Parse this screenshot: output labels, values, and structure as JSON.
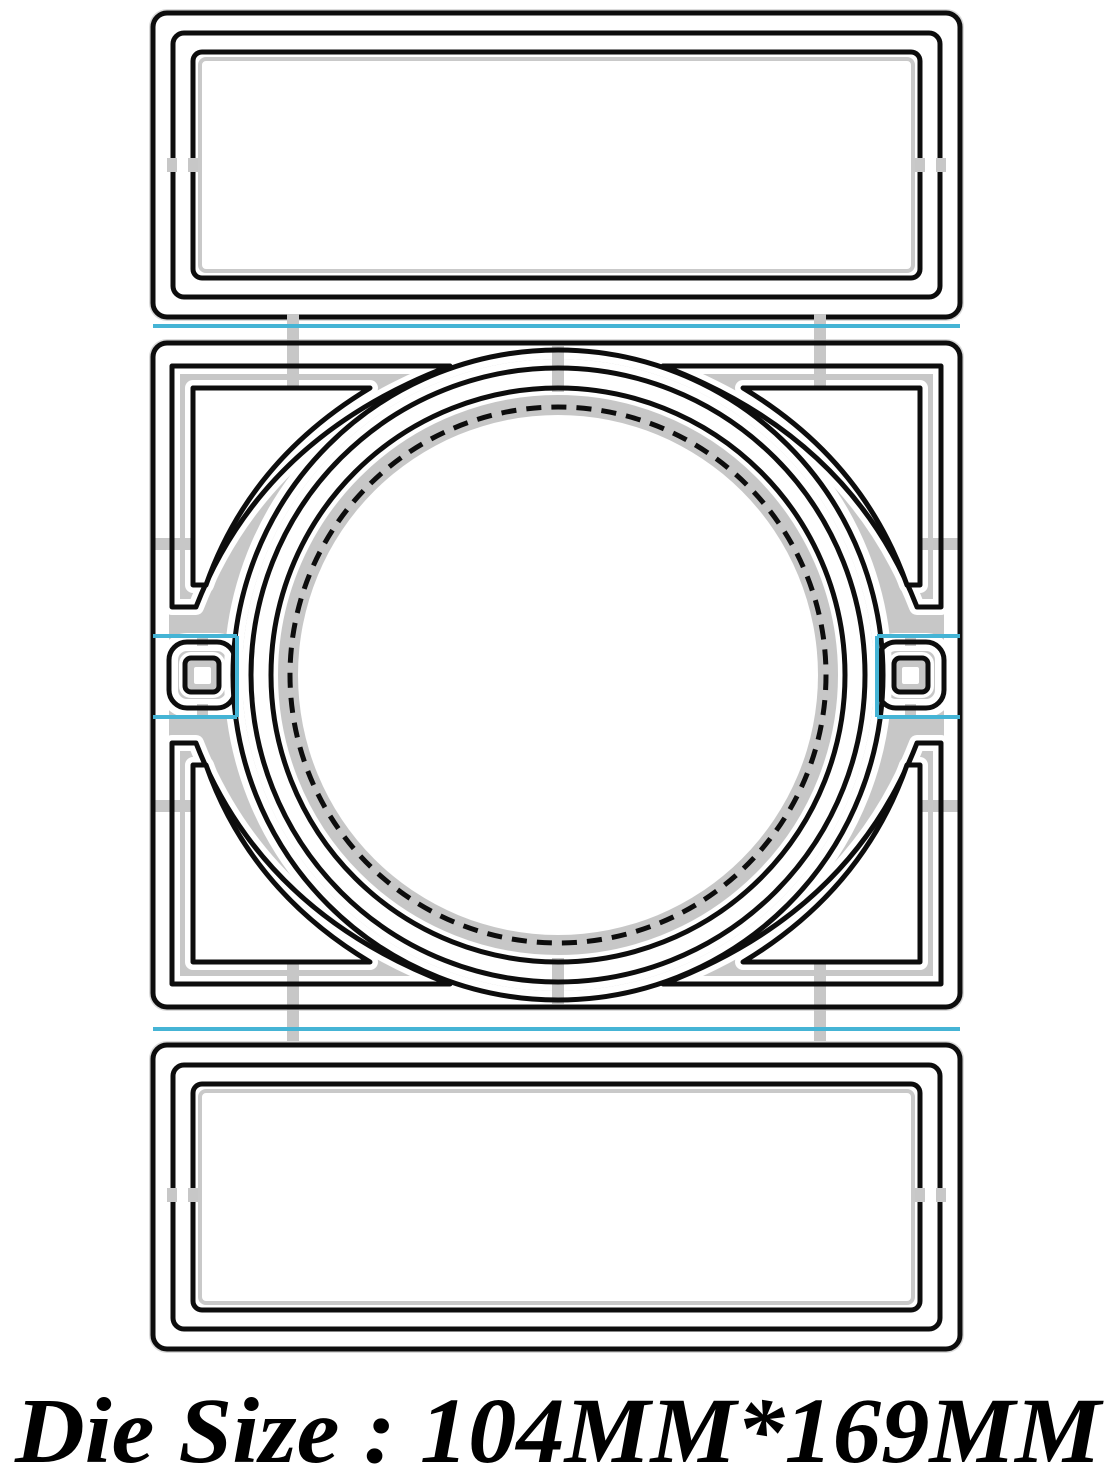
{
  "caption": {
    "text": "Die Size : 104MM*169MM"
  },
  "die": {
    "size_label": "104MM*169MM",
    "width_label": "104MM",
    "height_label": "169MM"
  },
  "colors": {
    "background": "#ffffff",
    "plate_gray": "#c7c7c7",
    "fringe_gray": "#dadada",
    "cut_black": "#0d0d0d",
    "halo_white": "#ffffff",
    "accent_cyan": "#45b4d5",
    "text_black": "#000000"
  }
}
